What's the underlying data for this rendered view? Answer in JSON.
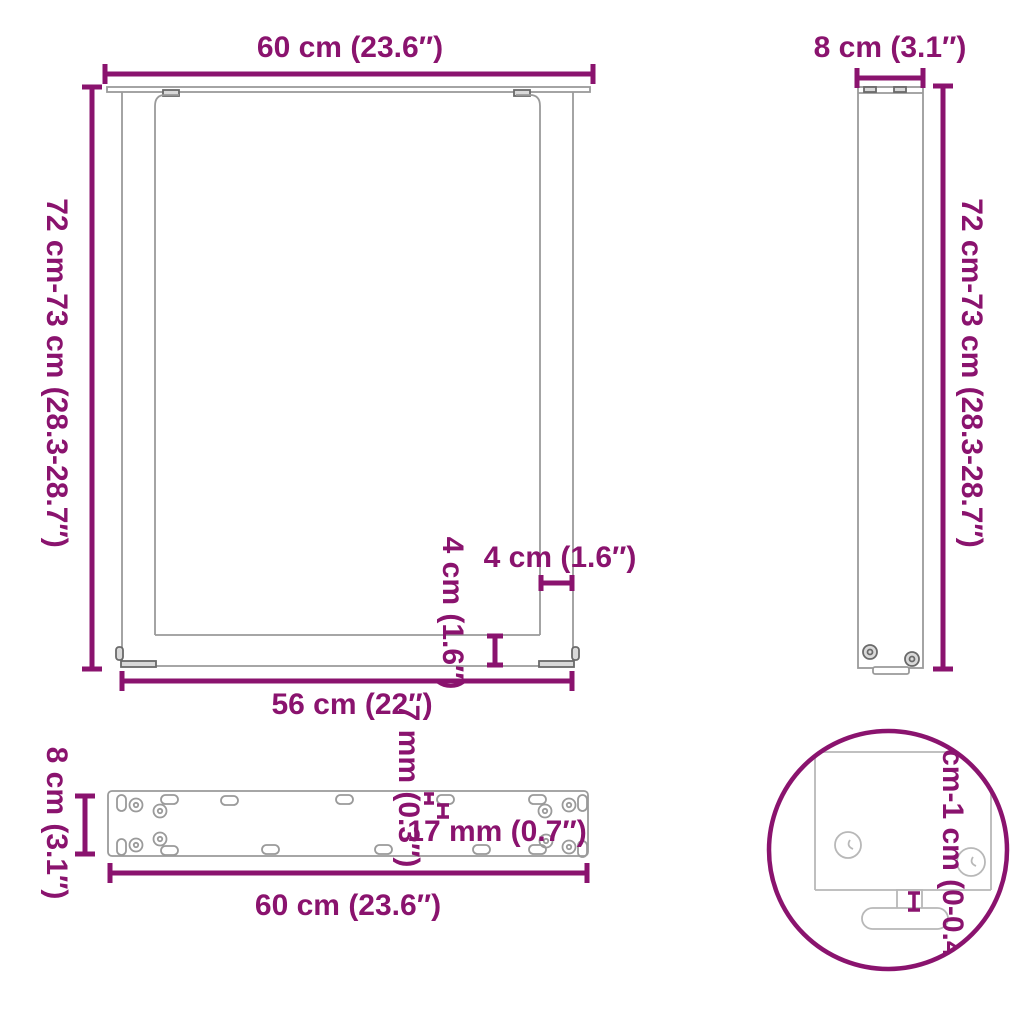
{
  "title": "U-shaped table leg dimension diagram",
  "colors": {
    "accent": "#8A136E",
    "outline": "#9a9a9a",
    "detail": "#6a6a6a"
  },
  "front": {
    "width_label": "60 cm (23.6″)",
    "height_label": "72 cm-73 cm (28.3-28.7″)",
    "inner_width_label": "56 cm (22″)",
    "leg_thickness_label": "4 cm (1.6″)",
    "crossbar_height_label": "4 cm (1.6″)"
  },
  "side": {
    "depth_label": "8 cm (3.1″)",
    "height_label": "72 cm-73 cm (28.3-28.7″)"
  },
  "plate": {
    "depth_label": "8 cm (3.1″)",
    "length_label": "60 cm (23.6″)",
    "hole_diameter_label": "7 mm (0.3″)",
    "slot_length_label": "17 mm (0.7″)"
  },
  "detail": {
    "adjustable_range_label": "0 cm-1 cm (0-0.4″)"
  }
}
